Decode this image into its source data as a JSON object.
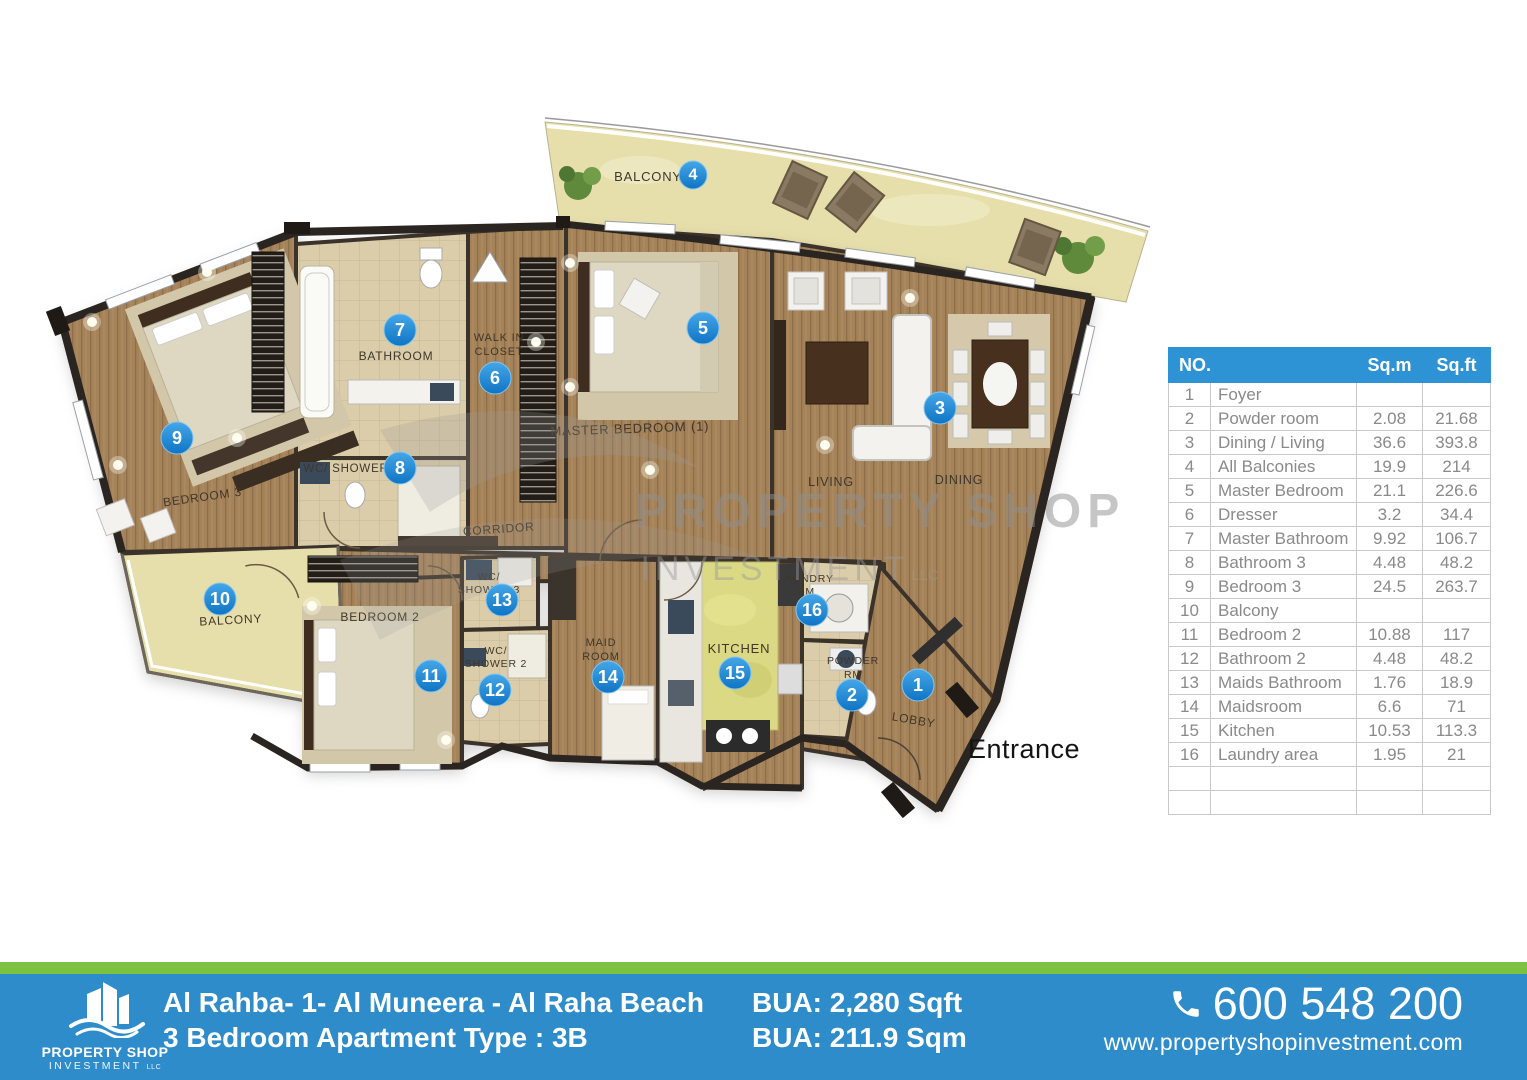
{
  "colors": {
    "footer_blue": "#2E8CCB",
    "footer_green": "#7CC242",
    "table_header_blue": "#2E93D4",
    "marker_blue": "#1E84D0",
    "wood": "#A5835A",
    "sand": "#E7DFAB"
  },
  "watermark": {
    "line1": "PROPERTY SHOP",
    "line2": "INVESTMENT",
    "suffix": "LLC"
  },
  "plan": {
    "entrance": "Entrance",
    "labels": {
      "balcony_top": "BALCONY",
      "bathroom": "BATHROOM",
      "walk_in_1": "WALK IN",
      "walk_in_2": "CLOSET",
      "master_bedroom": "MASTER BEDROOM (1)",
      "wc_shower": "WC/ SHOWER",
      "bedroom_3": "BEDROOM 3",
      "corridor": "CORRIDOR",
      "living": "LIVING",
      "dining": "DINING",
      "balcony_left": "BALCONY",
      "bedroom_2": "BEDROOM 2",
      "wc_shower_3a": "WC/",
      "wc_shower_3b": "SHOWER 3",
      "wc_shower_2a": "WC/",
      "wc_shower_2b": "SHOWER 2",
      "maid_1": "MAID",
      "maid_2": "ROOM",
      "kitchen": "KITCHEN",
      "laundry_1": "LAUNDRY",
      "laundry_2": "RM",
      "powder_1": "POWDER",
      "powder_2": "RM",
      "lobby": "LOBBY"
    },
    "markers": {
      "m1": "1",
      "m2": "2",
      "m3": "3",
      "m4": "4",
      "m5": "5",
      "m6": "6",
      "m7": "7",
      "m8": "8",
      "m9": "9",
      "m10": "10",
      "m11": "11",
      "m12": "12",
      "m13": "13",
      "m14": "14",
      "m15": "15",
      "m16": "16"
    }
  },
  "area_table": {
    "headers": {
      "no": "NO.",
      "sqm": "Sq.m",
      "sqft": "Sq.ft"
    },
    "rows": [
      {
        "no": "1",
        "name": "Foyer",
        "sqm": "",
        "sqft": ""
      },
      {
        "no": "2",
        "name": "Powder room",
        "sqm": "2.08",
        "sqft": "21.68"
      },
      {
        "no": "3",
        "name": "Dining / Living",
        "sqm": "36.6",
        "sqft": "393.8"
      },
      {
        "no": "4",
        "name": "All Balconies",
        "sqm": "19.9",
        "sqft": "214"
      },
      {
        "no": "5",
        "name": "Master Bedroom",
        "sqm": "21.1",
        "sqft": "226.6"
      },
      {
        "no": "6",
        "name": "Dresser",
        "sqm": "3.2",
        "sqft": "34.4"
      },
      {
        "no": "7",
        "name": "Master Bathroom",
        "sqm": "9.92",
        "sqft": "106.7"
      },
      {
        "no": "8",
        "name": "Bathroom 3",
        "sqm": "4.48",
        "sqft": "48.2"
      },
      {
        "no": "9",
        "name": "Bedroom 3",
        "sqm": "24.5",
        "sqft": "263.7"
      },
      {
        "no": "10",
        "name": "Balcony",
        "sqm": "",
        "sqft": ""
      },
      {
        "no": "11",
        "name": "Bedroom 2",
        "sqm": "10.88",
        "sqft": "117"
      },
      {
        "no": "12",
        "name": "Bathroom 2",
        "sqm": "4.48",
        "sqft": "48.2"
      },
      {
        "no": "13",
        "name": "Maids Bathroom",
        "sqm": "1.76",
        "sqft": "18.9"
      },
      {
        "no": "14",
        "name": "Maidsroom",
        "sqm": "6.6",
        "sqft": "71"
      },
      {
        "no": "15",
        "name": "Kitchen",
        "sqm": "10.53",
        "sqft": "113.3"
      },
      {
        "no": "16",
        "name": "Laundry area",
        "sqm": "1.95",
        "sqft": "21"
      },
      {
        "no": "",
        "name": "",
        "sqm": "",
        "sqft": ""
      },
      {
        "no": "",
        "name": "",
        "sqm": "",
        "sqft": ""
      }
    ]
  },
  "footer": {
    "logo_line1": "PROPERTY SHOP",
    "logo_line2": "INVESTMENT",
    "logo_suffix": "LLC",
    "address_line1": "Al Rahba- 1- Al Muneera - Al Raha Beach",
    "address_line2": "3 Bedroom Apartment Type : 3B",
    "bua_sqft": "BUA: 2,280 Sqft",
    "bua_sqm": "BUA: 211.9 Sqm",
    "phone": "600 548 200",
    "website": "www.propertyshopinvestment.com"
  }
}
